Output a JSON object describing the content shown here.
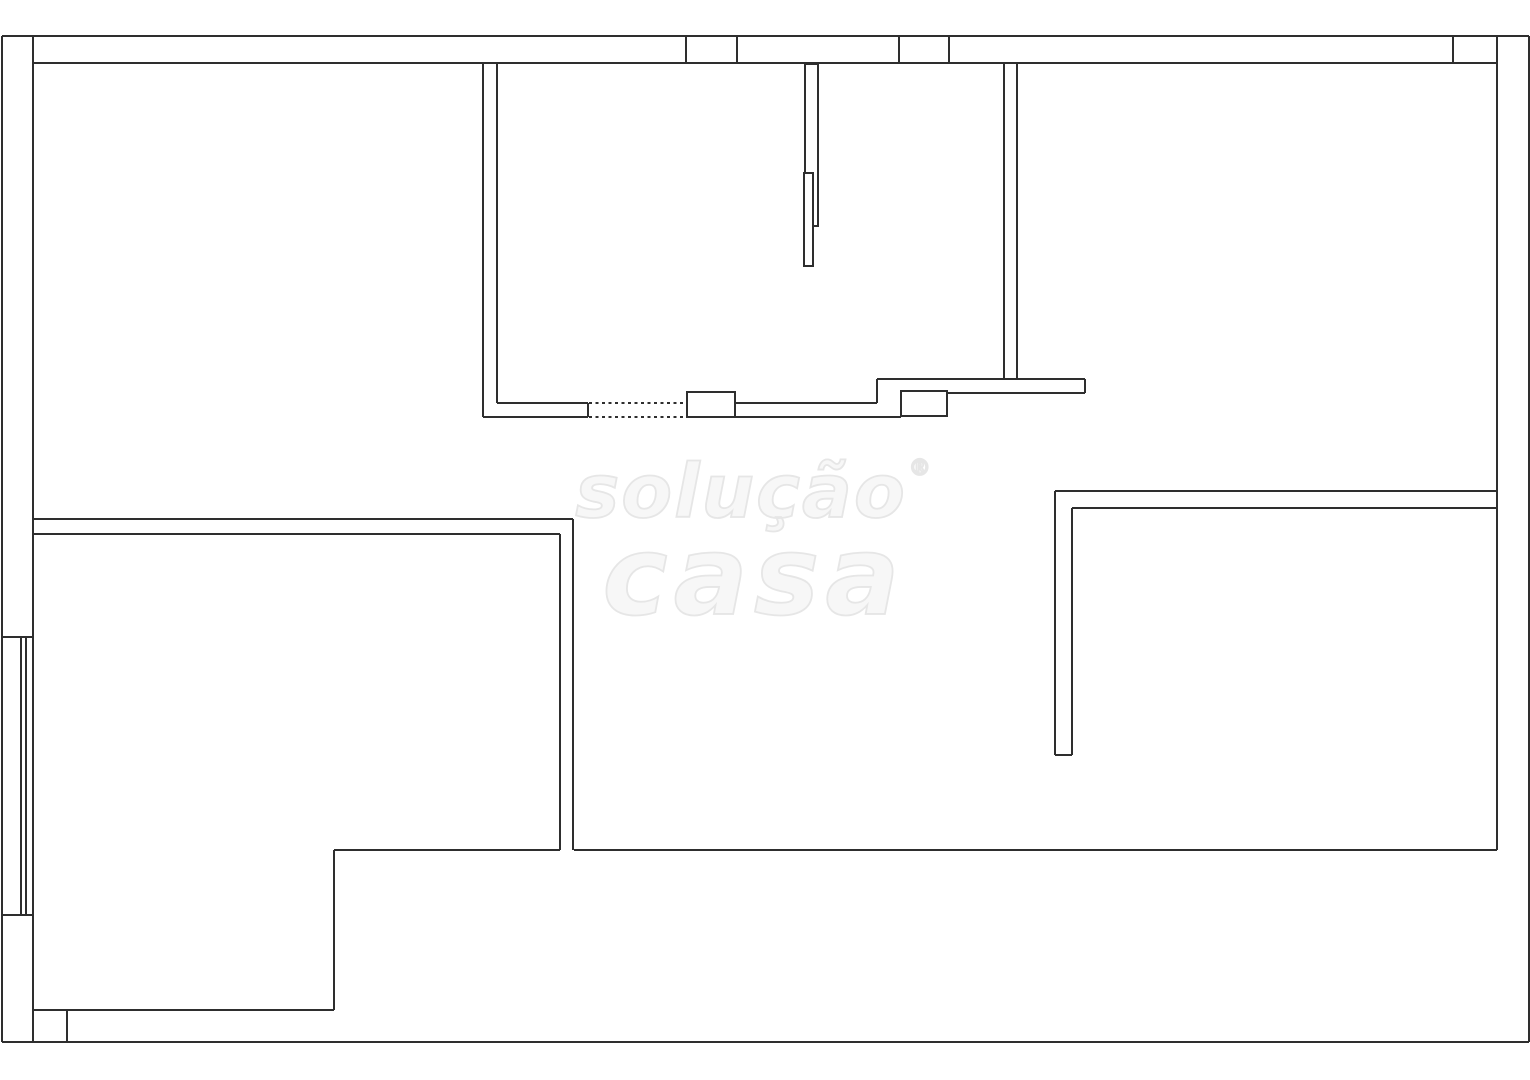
{
  "page": {
    "background": "#ffffff"
  },
  "watermark": {
    "line1": "solução",
    "registered": "®",
    "line2": "casa",
    "fill": "#f7f7f7",
    "stroke": "#e6e6e6"
  },
  "floorplan": {
    "canvas": {
      "width": 1530,
      "height": 1080
    },
    "stroke_color": "#2e2e2e",
    "stroke_width": 2,
    "dash_pattern": "3 3.5",
    "solid_lines": [
      {
        "name": "top-wall-outer",
        "pts": [
          2,
          36,
          1529,
          36
        ]
      },
      {
        "name": "top-wall-inner",
        "pts": [
          33,
          63,
          1497,
          63
        ]
      },
      {
        "name": "left-wall-outer",
        "pts": [
          2,
          36,
          2,
          1042
        ]
      },
      {
        "name": "left-wall-inner",
        "pts": [
          33,
          36,
          33,
          1042
        ]
      },
      {
        "name": "right-wall-outer",
        "pts": [
          1529,
          36,
          1529,
          1042
        ]
      },
      {
        "name": "right-wall-inner",
        "pts": [
          1497,
          36,
          1497,
          850
        ]
      },
      {
        "name": "bottom-wall-outer",
        "pts": [
          2,
          1042,
          1529,
          1042
        ]
      },
      {
        "name": "top-wall-tick-1",
        "pts": [
          686,
          36,
          686,
          63
        ]
      },
      {
        "name": "top-wall-tick-2",
        "pts": [
          737,
          36,
          737,
          63
        ]
      },
      {
        "name": "top-wall-tick-3",
        "pts": [
          899,
          36,
          899,
          63
        ]
      },
      {
        "name": "top-wall-tick-4",
        "pts": [
          949,
          36,
          949,
          63
        ]
      },
      {
        "name": "top-wall-tick-5",
        "pts": [
          1453,
          36,
          1453,
          63
        ]
      },
      {
        "name": "left-window-sill-top",
        "pts": [
          2,
          637,
          33,
          637
        ]
      },
      {
        "name": "left-window-sill-bottom",
        "pts": [
          2,
          915,
          33,
          915
        ]
      },
      {
        "name": "left-window-glass-1",
        "pts": [
          21,
          637,
          21,
          915
        ]
      },
      {
        "name": "left-window-glass-2",
        "pts": [
          26,
          637,
          26,
          915
        ]
      },
      {
        "name": "bottom-wall-tick",
        "pts": [
          67,
          1010,
          67,
          1042
        ]
      },
      {
        "name": "kitchen-wall-left-outer",
        "pts": [
          483,
          63,
          483,
          417
        ]
      },
      {
        "name": "kitchen-wall-left-inner",
        "pts": [
          497,
          63,
          497,
          403
        ]
      },
      {
        "name": "kitchen-wall-top-edge",
        "pts": [
          497,
          403,
          588,
          403
        ]
      },
      {
        "name": "kitchen-wall-bottom-edge",
        "pts": [
          483,
          417,
          588,
          417
        ]
      },
      {
        "name": "kitchen-wall-end-cap",
        "pts": [
          588,
          403,
          588,
          417
        ]
      },
      {
        "name": "kitchen-wall-top-edge-2",
        "pts": [
          735,
          403,
          877,
          403
        ]
      },
      {
        "name": "kitchen-wall-bottom-edge-2",
        "pts": [
          735,
          417,
          901,
          417
        ]
      },
      {
        "name": "counter-step-up",
        "pts": [
          877,
          379,
          877,
          403
        ]
      },
      {
        "name": "counter-top-edge",
        "pts": [
          877,
          379,
          1085,
          379
        ]
      },
      {
        "name": "counter-end-cap",
        "pts": [
          1085,
          379,
          1085,
          393
        ]
      },
      {
        "name": "counter-bottom-edge",
        "pts": [
          948,
          393,
          1085,
          393
        ]
      },
      {
        "name": "hall-wall-left-line",
        "pts": [
          1004,
          63,
          1004,
          379
        ]
      },
      {
        "name": "hall-wall-right-line",
        "pts": [
          1017,
          63,
          1017,
          379
        ]
      },
      {
        "name": "left-room-top-outer",
        "pts": [
          33,
          519,
          573,
          519
        ]
      },
      {
        "name": "left-room-top-inner",
        "pts": [
          33,
          534,
          560,
          534
        ]
      },
      {
        "name": "left-room-right-outer",
        "pts": [
          573,
          519,
          573,
          850
        ]
      },
      {
        "name": "left-room-right-inner",
        "pts": [
          560,
          534,
          560,
          850
        ]
      },
      {
        "name": "left-room-bottom-edge",
        "pts": [
          334,
          850,
          560,
          850
        ]
      },
      {
        "name": "bottom-interior-wall",
        "pts": [
          574,
          850,
          1497,
          850
        ]
      },
      {
        "name": "left-room-step-vertical",
        "pts": [
          334,
          850,
          334,
          1010
        ]
      },
      {
        "name": "left-room-step-horizontal",
        "pts": [
          33,
          1010,
          334,
          1010
        ]
      },
      {
        "name": "right-room-top-outer",
        "pts": [
          1055,
          491,
          1497,
          491
        ]
      },
      {
        "name": "right-room-top-inner",
        "pts": [
          1072,
          508,
          1497,
          508
        ]
      },
      {
        "name": "right-room-left-outer",
        "pts": [
          1055,
          491,
          1055,
          755
        ]
      },
      {
        "name": "right-room-left-inner",
        "pts": [
          1072,
          508,
          1072,
          755
        ]
      },
      {
        "name": "right-room-wall-end-cap",
        "pts": [
          1055,
          755,
          1072,
          755
        ]
      }
    ],
    "dashed_lines": [
      {
        "name": "hidden-wall-top-edge",
        "pts": [
          589,
          403,
          683,
          403
        ]
      },
      {
        "name": "hidden-wall-bottom-edge",
        "pts": [
          589,
          417,
          683,
          417
        ]
      }
    ],
    "boxes": [
      {
        "name": "door-wall-band",
        "x": 805,
        "y": 64,
        "w": 13,
        "h": 162
      },
      {
        "name": "pillar-1",
        "x": 687,
        "y": 392,
        "w": 48,
        "h": 25
      },
      {
        "name": "pillar-2",
        "x": 901,
        "y": 391,
        "w": 46,
        "h": 25
      },
      {
        "name": "door-leaf",
        "x": 804,
        "y": 173,
        "w": 9,
        "h": 93
      }
    ]
  }
}
